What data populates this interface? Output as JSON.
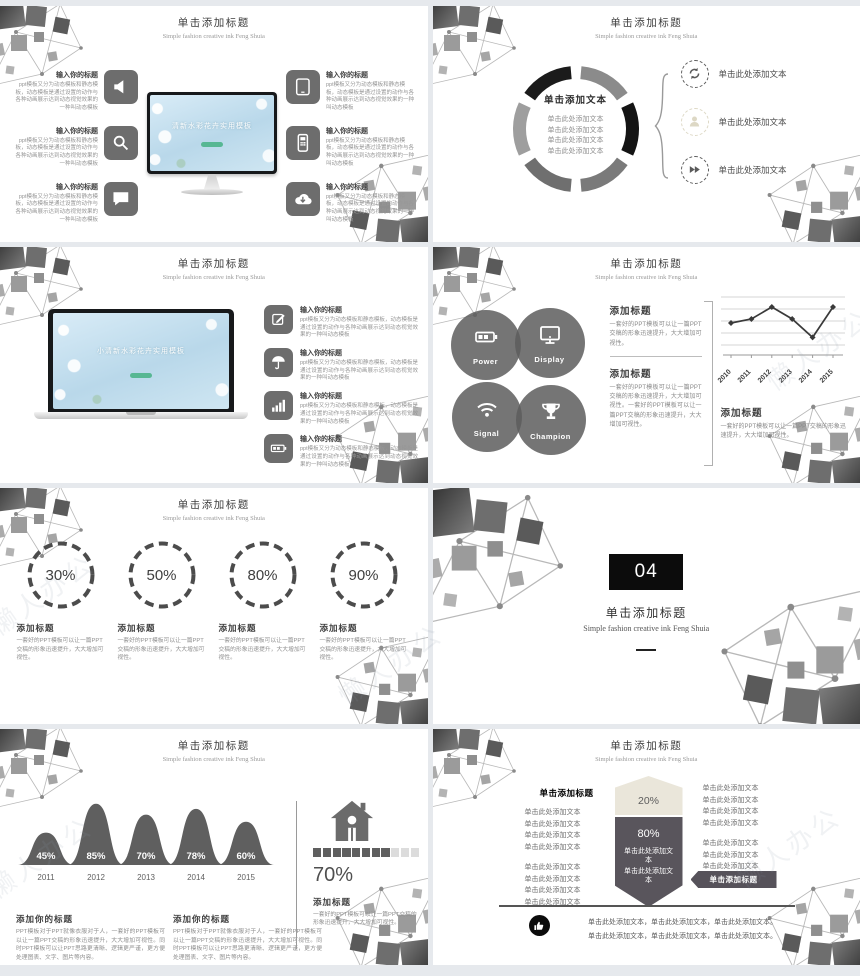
{
  "page": {
    "watermark_text": "懒人办公"
  },
  "common": {
    "title": "单击添加标题",
    "subtitle": "Simple fashion creative ink Feng Shuia"
  },
  "texts": {
    "item_heading": "输入你的标题",
    "item_body": "ppt模板又分为动态模板和静态模板，动态模板是通过设置的动作与各种动画展示达到动态视觉效果的一种叫动态模板",
    "add_heading": "添加标题",
    "add_your_heading": "添加你的标题",
    "body_short": "一套好的PPT模板可以让一篇PPT交稿的形象迅速提升，大大增加可视性。",
    "body_double": "一套好的PPT模板可以让一篇PPT交稿的形象迅速提升，大大增加可视性。一套好的PPT模板可以让一篇PPT交稿的形象迅速提升，大大增加可视性。",
    "body_long": "PPT模板对于PPT就像衣服对于人，一套好的PPT模板可以让一篇PPT交稿的形象迅速提升，大大增加可视性。同时PPT模板可以让PPT思路更清晰、逻辑更严谨，更方便处理图表、文字、图片等内容。",
    "click_add_text": "单击添加文本",
    "click_add_here": "单击此处添加文本",
    "click_add_title": "单击添加标题",
    "footer_line": "单击此处添加文本，单击此处添加文本，单击此处添加文本。"
  },
  "slide1": {
    "screen_title": "清新水彩花卉实用模板",
    "left_icons": [
      "speaker-icon",
      "search-icon",
      "chat-icon"
    ],
    "right_icons": [
      "tablet-icon",
      "mobile-icon",
      "cloud-download-icon"
    ]
  },
  "slide2": {
    "center_title": "单击添加文本",
    "item_icons": [
      "refresh-icon",
      "user-icon",
      "fast-forward-icon"
    ]
  },
  "slide3": {
    "screen_title": "小清新水彩花卉实用模板",
    "icons": [
      "edit-icon",
      "umbrella-icon",
      "bar-chart-icon",
      "battery-icon"
    ]
  },
  "slide4": {
    "circles": [
      {
        "icon": "battery-icon",
        "label": "Power"
      },
      {
        "icon": "display-icon",
        "label": "Display"
      },
      {
        "icon": "wifi-icon",
        "label": "Signal"
      },
      {
        "icon": "trophy-icon",
        "label": "Champion"
      }
    ]
  },
  "slide5": {
    "percents": [
      "30%",
      "50%",
      "80%",
      "90%"
    ]
  },
  "slide6": {
    "number": "04"
  },
  "slide7": {
    "right_percent": "70%"
  },
  "slide8": {
    "top_percent": "20%",
    "bottom_percent": "80%"
  },
  "chart_data": [
    {
      "type": "line",
      "location": "row-2 right slide",
      "x": [
        "2010",
        "2011",
        "2012",
        "2013",
        "2014",
        "2015"
      ],
      "values": [
        3,
        3.5,
        5,
        3.5,
        1.2,
        5
      ],
      "ylim": [
        0,
        6
      ],
      "grid": true,
      "marker": "diamond",
      "line_color": "#3a3a3a"
    },
    {
      "type": "area",
      "subtype": "bell-curves",
      "location": "row-4 left slide",
      "categories": [
        "2011",
        "2012",
        "2013",
        "2014",
        "2015"
      ],
      "values": [
        45,
        85,
        70,
        78,
        60
      ],
      "unit": "%",
      "fill_color": "#5f5f5f"
    },
    {
      "type": "progress-squares",
      "location": "row-4 left slide",
      "percent": 70,
      "filled": 8,
      "total": 11
    },
    {
      "type": "funnel",
      "location": "row-4 right slide",
      "segments": [
        {
          "label": "20%",
          "color": "#eae6da"
        },
        {
          "label": "80%",
          "color": "#59555c"
        }
      ]
    }
  ]
}
